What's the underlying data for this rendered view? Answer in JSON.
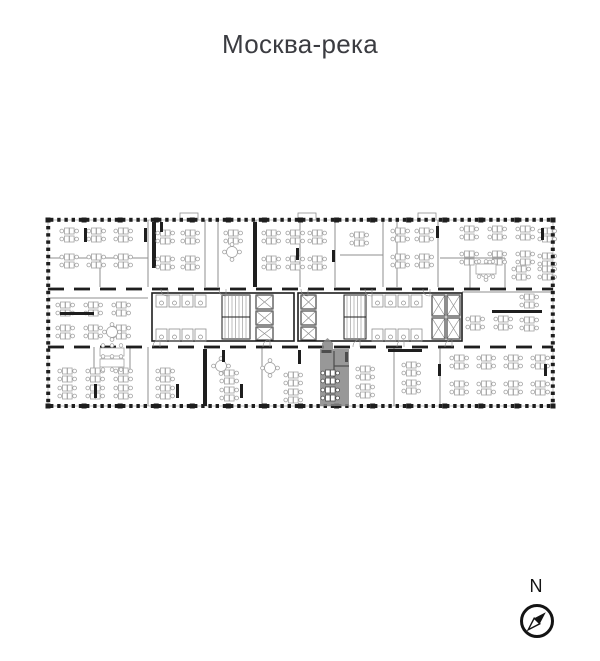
{
  "title": "Москва-река",
  "compass": {
    "label": "N",
    "cx": 537,
    "cy": 621,
    "r": 15.5
  },
  "colors": {
    "title": "#3b3c41",
    "wall": "#1e1e1e",
    "outline": "#b5b5b5",
    "partition": "#8f8f8f",
    "furniture": "#a2a2a2",
    "furniture_dark": "#4f4f4f",
    "compass": "#141414",
    "highlight": "#868686"
  },
  "plan": {
    "bbox": [
      48,
      220,
      505,
      186
    ],
    "tick": {
      "step": 7.2,
      "w": 3.4,
      "len": 4
    },
    "protrusions": [
      [
        180,
        213,
        18,
        7
      ],
      [
        298,
        213,
        18,
        7
      ],
      [
        418,
        213,
        18,
        7
      ]
    ],
    "walls_thin": [
      [
        100,
        258,
        100,
        287
      ],
      [
        148,
        220,
        148,
        287
      ],
      [
        205,
        220,
        205,
        287
      ],
      [
        218,
        220,
        218,
        287
      ],
      [
        256,
        220,
        256,
        287
      ],
      [
        300,
        220,
        300,
        287
      ],
      [
        335,
        220,
        335,
        287
      ],
      [
        383,
        220,
        383,
        287
      ],
      [
        397,
        220,
        397,
        287
      ],
      [
        438,
        220,
        438,
        287
      ],
      [
        470,
        258,
        470,
        289
      ],
      [
        505,
        258,
        505,
        289
      ],
      [
        48,
        258,
        148,
        258
      ],
      [
        340,
        255,
        383,
        255
      ],
      [
        440,
        258,
        505,
        258
      ],
      [
        48,
        298,
        148,
        298
      ],
      [
        462,
        292,
        553,
        292
      ],
      [
        94,
        347,
        94,
        370
      ],
      [
        130,
        347,
        130,
        370
      ],
      [
        148,
        347,
        148,
        406
      ],
      [
        262,
        347,
        262,
        406
      ],
      [
        394,
        347,
        394,
        406
      ],
      [
        440,
        347,
        440,
        406
      ]
    ],
    "dashed_walls": [
      [
        48,
        289,
        553
      ],
      [
        48,
        347,
        553
      ]
    ],
    "walls_thick": [
      [
        152,
        222,
        4,
        46
      ],
      [
        253,
        222,
        4,
        65
      ],
      [
        203,
        349,
        4,
        57
      ]
    ],
    "cores": [
      [
        152,
        293,
        142,
        48
      ],
      [
        298,
        293,
        164,
        48
      ]
    ],
    "shafts": [
      [
        256,
        295,
        17,
        14
      ],
      [
        256,
        311,
        17,
        14
      ],
      [
        256,
        327,
        17,
        13
      ],
      [
        301,
        295,
        15,
        14
      ],
      [
        301,
        311,
        15,
        14
      ],
      [
        301,
        327,
        15,
        13
      ],
      [
        432,
        295,
        13,
        21
      ],
      [
        447,
        295,
        13,
        21
      ],
      [
        432,
        318,
        13,
        21
      ],
      [
        447,
        318,
        13,
        21
      ]
    ],
    "stairs": [
      [
        222,
        295,
        28,
        44
      ],
      [
        344,
        295,
        22,
        44
      ]
    ],
    "stalls": [
      [
        156,
        295,
        4
      ],
      [
        156,
        329,
        4
      ],
      [
        372,
        295,
        4
      ],
      [
        372,
        329,
        4
      ]
    ],
    "desk_grids": [
      [
        60,
        228,
        3,
        2,
        27,
        26
      ],
      [
        156,
        230,
        2,
        2,
        25,
        26
      ],
      [
        224,
        230,
        1,
        1,
        0,
        0
      ],
      [
        262,
        230,
        2,
        2,
        24,
        26
      ],
      [
        308,
        230,
        1,
        2,
        0,
        26
      ],
      [
        350,
        232,
        1,
        1,
        0,
        0
      ],
      [
        391,
        228,
        2,
        2,
        24,
        26
      ],
      [
        460,
        226,
        3,
        2,
        28,
        25
      ],
      [
        538,
        228,
        1,
        2,
        0,
        25
      ],
      [
        512,
        266,
        2,
        1,
        26,
        0
      ],
      [
        520,
        294,
        1,
        2,
        0,
        23
      ],
      [
        466,
        316,
        2,
        1,
        28,
        0
      ],
      [
        56,
        302,
        3,
        2,
        28,
        23
      ],
      [
        58,
        368,
        3,
        2,
        28,
        17
      ],
      [
        156,
        368,
        1,
        2,
        0,
        17
      ],
      [
        220,
        370,
        1,
        2,
        0,
        17
      ],
      [
        284,
        372,
        1,
        2,
        0,
        17
      ],
      [
        356,
        366,
        1,
        2,
        0,
        18
      ],
      [
        402,
        362,
        1,
        2,
        0,
        18
      ],
      [
        450,
        355,
        4,
        2,
        27,
        26
      ]
    ],
    "round_tables": [
      [
        232,
        252
      ],
      [
        112,
        332
      ],
      [
        486,
        272
      ],
      [
        221,
        366
      ],
      [
        270,
        368
      ]
    ],
    "conf_tables": [
      [
        100,
        348,
        24,
        8
      ],
      [
        100,
        359,
        24,
        8
      ],
      [
        476,
        264,
        20,
        10
      ]
    ],
    "cabinets": [
      [
        84,
        228,
        3,
        14
      ],
      [
        144,
        228,
        3,
        14
      ],
      [
        296,
        248,
        3,
        12
      ],
      [
        332,
        250,
        3,
        12
      ],
      [
        436,
        226,
        3,
        12
      ],
      [
        541,
        228,
        3,
        12
      ],
      [
        160,
        222,
        3,
        10
      ],
      [
        60,
        312,
        34,
        3
      ],
      [
        492,
        310,
        50,
        3
      ],
      [
        94,
        384,
        3,
        14
      ],
      [
        176,
        384,
        3,
        14
      ],
      [
        240,
        384,
        3,
        14
      ],
      [
        298,
        350,
        3,
        14
      ],
      [
        388,
        349,
        34,
        3
      ],
      [
        438,
        364,
        3,
        12
      ],
      [
        544,
        364,
        3,
        12
      ],
      [
        222,
        350,
        3,
        12
      ]
    ],
    "door_arcs": [
      [
        168,
        289,
        7,
        1
      ],
      [
        226,
        289,
        7,
        1
      ],
      [
        308,
        289,
        7,
        1
      ],
      [
        372,
        289,
        7,
        1
      ],
      [
        430,
        289,
        7,
        1
      ],
      [
        160,
        347,
        7,
        0
      ],
      [
        270,
        347,
        7,
        0
      ],
      [
        360,
        347,
        7,
        0
      ],
      [
        404,
        347,
        7,
        0
      ],
      [
        452,
        347,
        7,
        0
      ]
    ],
    "highlight": {
      "color": "#868686",
      "opacity": 0.85,
      "wall_color": "#4d4d4d",
      "points": "320,406 320,349 322,349 322,343 327.5,338 333,343 333,349 349,349 349,406",
      "lines": [
        [
          334,
          351,
          334,
          377
        ],
        [
          334,
          366,
          349,
          366
        ]
      ],
      "cabinets": [
        [
          321.5,
          350,
          10,
          3
        ],
        [
          345,
          352,
          3,
          10
        ]
      ],
      "desk_grids": [
        [
          321,
          370,
          1,
          2,
          0,
          17
        ]
      ]
    }
  }
}
